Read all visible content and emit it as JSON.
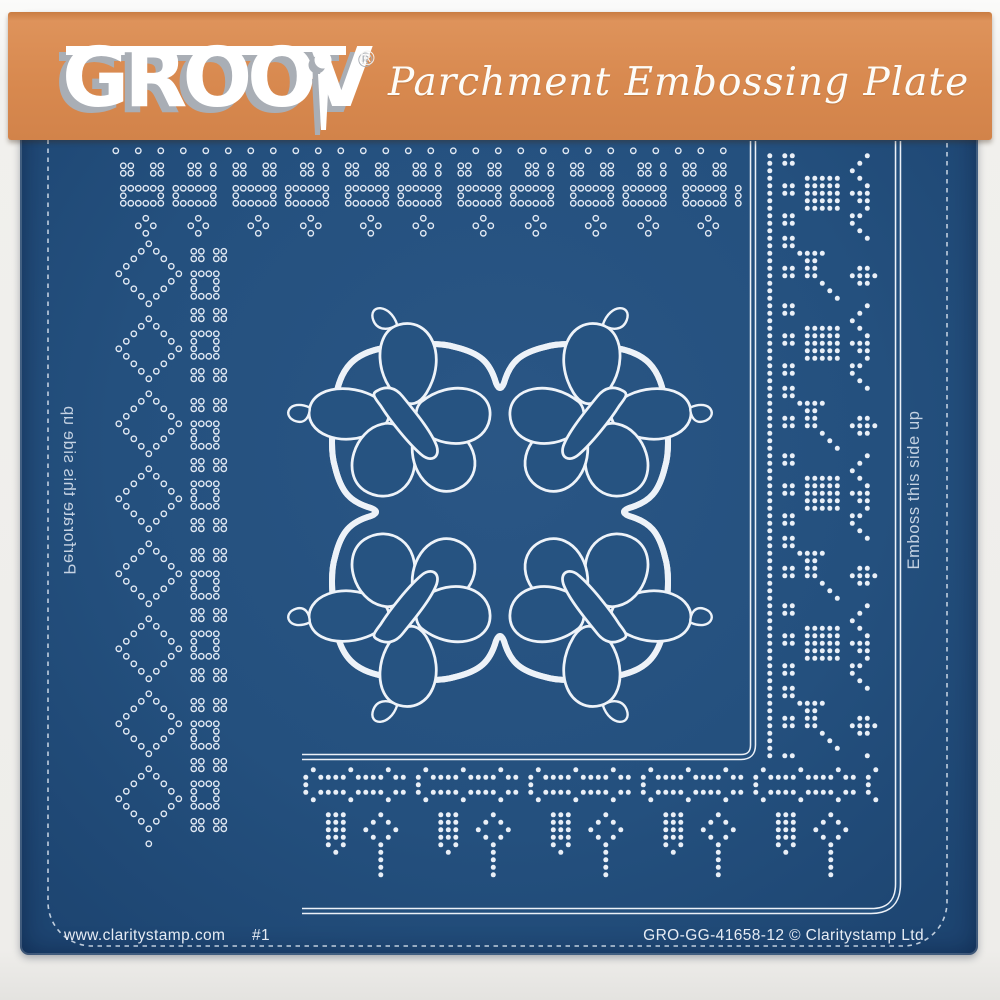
{
  "header": {
    "brand_prefix": "GROOV",
    "brand_suffix_icon": "embossing-tool-i",
    "registered": "®",
    "tagline": "Parchment Embossing Plate",
    "band_color": "#d8894f"
  },
  "plate": {
    "base_color": "#24507e",
    "pattern_color": "#e9eff7",
    "left_note": "Perforate this side up",
    "left_note_style": "mirrored, reads bottom to top",
    "right_note": "Emboss this side up",
    "right_note_style": "reads bottom to top"
  },
  "footer": {
    "website": "www.claritystamp.com",
    "plate_number": "#1",
    "code": "GRO-GG-41658-12 © Claritystamp Ltd"
  },
  "borders": {
    "tiles": {
      "ringsTop": [
        "o..o..o..o..o..",
        "...............",
        ".oo..oo...oo.o.",
        ".oo..oo...oo.o.",
        "...............",
        ".oooooo.oooooo.",
        ".o....o.o....o.",
        ".oooooo.oooooo.",
        "...............",
        "....o......o...",
        "...o.o....o.o..",
        "....o......o..."
      ],
      "ringsLeft": [
        "......o...........",
        ".....o.o....oo.oo.",
        "....o...o...oo.oo.",
        "...o.....o........",
        "..o.......o.oooo..",
        "...o.....o..o..o..",
        "....o...o...o..o..",
        ".....o.o....oooo..",
        "......o...........",
        "............oo.oo.",
        "......o.....oo.oo.",
        ".....o.o..........",
        "....o...o...oooo..",
        "...o.....o..o..o..",
        "..o.......o.o..o..",
        "...o.....o..oooo..",
        "....o...o.........",
        ".....o.o....oo.oo.",
        "......o.....oo.oo.",
        ".................."
      ],
      "dotsRight": [
        "#.##.........#..",
        "#.##........#...",
        "#..........#....",
        "#....#####..#...",
        "#.##.#####...#..",
        "#.##.#####.###..",
        "#....#####..##..",
        "#....#####...#..",
        "#.##.......##...",
        "#.##.......#....",
        "#...........#...",
        "#.##.........#..",
        "#.##............",
        "#...####........",
        "#....##.........",
        "#.##.##.....##..",
        "#.##.##....####.",
        "#......#....##..",
        "#.......#.......",
        "#........#......"
      ],
      "dotsBottom": [
        ".#....#....#...",
        "#.####.####.##.",
        "#..............",
        "#.####.####.##.",
        ".#....#....#...",
        "...............",
        "...###....#....",
        "...###...#.#...",
        "...###..#...#..",
        "...###...#.#...",
        "...#.#....#....",
        "....#.....#....",
        "..........#....",
        "..........#....",
        "..........#....",
        "...............",
        "...............",
        "..............."
      ]
    },
    "regions": [
      {
        "name": "top-lace-border",
        "tile": "ringsTop",
        "x": 112,
        "y": 147,
        "w": 634,
        "h": 92,
        "cell": 7.5
      },
      {
        "name": "left-lace-border",
        "tile": "ringsLeft",
        "x": 100,
        "y": 240,
        "w": 135,
        "h": 612,
        "cell": 7.5
      },
      {
        "name": "right-dot-border",
        "tile": "dotsRight",
        "x": 766,
        "y": 152,
        "w": 122,
        "h": 610,
        "cell": 7.5
      },
      {
        "name": "bottom-dot-border",
        "tile": "dotsBottom",
        "x": 302,
        "y": 766,
        "w": 580,
        "h": 138,
        "cell": 7.5
      }
    ]
  }
}
